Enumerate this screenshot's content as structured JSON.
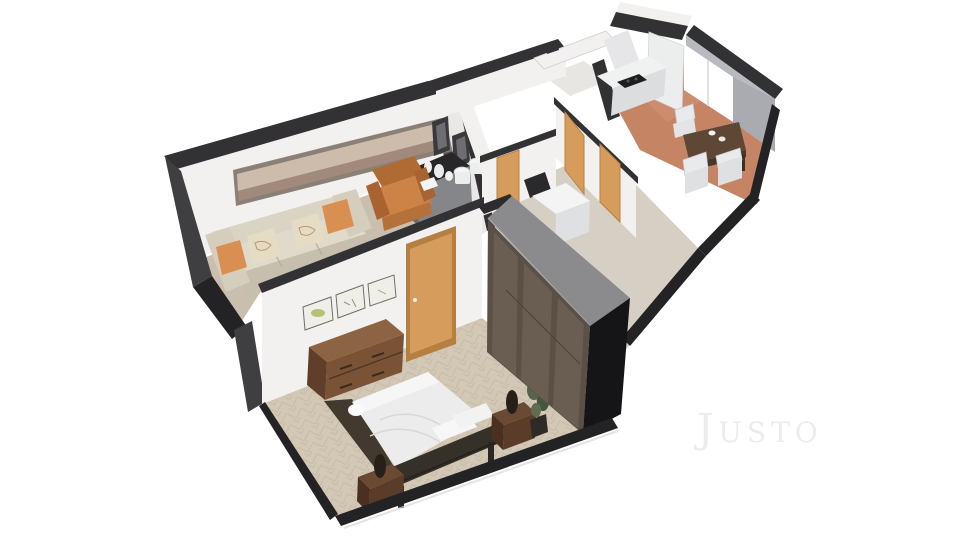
{
  "scene": {
    "type": "3d-floor-plan-render",
    "description": "Isometric 3D floor plan of a one-bedroom apartment",
    "background": "#ffffff"
  },
  "watermark": {
    "text": "Justo",
    "color": "#ececec"
  },
  "rooms": [
    {
      "id": "living-room",
      "label": "Living room",
      "floor": "carpet"
    },
    {
      "id": "bedroom",
      "label": "Bedroom",
      "floor": "herringbone wood"
    },
    {
      "id": "hallway",
      "label": "Hallway",
      "floor": "light stone"
    },
    {
      "id": "bathroom",
      "label": "Bathroom",
      "floor": "dark tile"
    },
    {
      "id": "wc",
      "label": "WC",
      "floor": "light tile"
    },
    {
      "id": "kitchen",
      "label": "Kitchen",
      "floor": "terracotta"
    },
    {
      "id": "dining-area",
      "label": "Dining area",
      "floor": "terracotta"
    }
  ],
  "furniture": {
    "living_room": [
      "sofa with pillows",
      "armchair",
      "sideboard with vases",
      "panoramic picture",
      "two wall frames"
    ],
    "bedroom": [
      "double bed",
      "headboard",
      "two nightstands with lamps",
      "dresser",
      "wardrobe",
      "potted plant",
      "three wall frames",
      "door"
    ],
    "hallway": [
      "washing machine",
      "toilet",
      "bidet",
      "three doors"
    ],
    "kitchen": [
      "counter with cooktop",
      "tall cabinet",
      "window"
    ],
    "dining_area": [
      "dining table",
      "three chairs"
    ]
  },
  "palette": {
    "wall_top": "#323234",
    "wall_dark": "#3f3f41",
    "wall_edge": "#232325",
    "wall_white": "#f2f1ef",
    "wall_shade": "#e9e8e6",
    "wall_gray": "#b9bac0",
    "carpet": "#cabfae",
    "wood_floor": "#d3c8b5",
    "wood_stroke": "#b9ac97",
    "hall_floor": "#d6d0c4",
    "tile_floor": "#c58565",
    "bath_floor": "#55524e",
    "wc_floor": "#e8e6e2",
    "door": "#d69c5c",
    "door_frame": "#b67f42",
    "sofa": "#dad4c4",
    "sofa_shadow": "#c6bfae",
    "pillow_orange": "#d98f52",
    "pillow_floral": "#e6dcc4",
    "armchair": "#cc8345",
    "picture_sky": "#cdbbac",
    "picture_land": "#a18a7c",
    "frame_dark": "#3a3a3c",
    "sideboard": "#85868a",
    "bed_duvet": "#ececec",
    "bed_frame": "#353028",
    "nightstand": "#6b4a34",
    "dresser": "#7a5236",
    "dresser_top": "#8d6443",
    "wardrobe_front": "#5b5046",
    "wardrobe_panel": "#6a5d52",
    "wardrobe_top": "#8b8b8d",
    "wardrobe_side": "#151517",
    "plant": "#55644b",
    "plant_pot": "#2e2a25",
    "table": "#5f4736",
    "chair": "#e9eaec",
    "counter": "#f0f1f1",
    "counter_front": "#dcdddf",
    "cooktop": "#1e1e20",
    "window": "#ffffff",
    "fixture_white": "#f4f4f4"
  }
}
